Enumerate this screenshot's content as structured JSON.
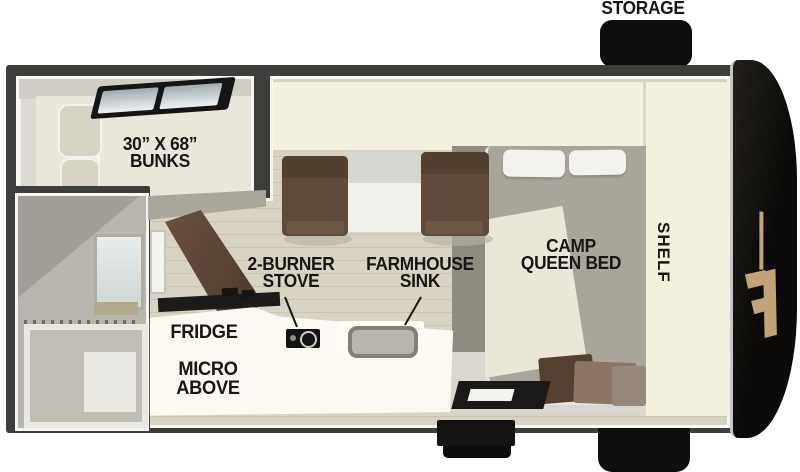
{
  "diagram": {
    "type": "rv-floorplan",
    "labels": {
      "storage": "STORAGE",
      "bunks_line1": "30” X 68”",
      "bunks_line2": "BUNKS",
      "stove_line1": "2-BURNER",
      "stove_line2": "STOVE",
      "sink_line1": "FARMHOUSE",
      "sink_line2": "SINK",
      "bed_line1": "CAMP",
      "bed_line2": "QUEEN BED",
      "shelf": "SHELF",
      "fridge": "FRIDGE",
      "micro_line1": "MICRO",
      "micro_line2": "ABOVE"
    },
    "colors": {
      "background": "#ffffff",
      "wall": "#3e3e3d",
      "wall_trim": "#f7f7f3",
      "floor_plank": "#d8d3c2",
      "floor_plank_line": "#c8c3b2",
      "cream_cabinet": "#f4f0de",
      "carpet_gray": "#8f8b81",
      "mattress_gray": "#a9a59b",
      "blanket_cream": "#ebe7d8",
      "seat_brown": "#604b3a",
      "door_brown": "#5c4536",
      "counter_white": "#fbf9f1",
      "accent_black": "#141312",
      "front_cap_black": "#0b0a08",
      "logo_tan": "#c2a277",
      "label_text": "#171614"
    },
    "icons": {
      "skylight": "skylight-icon (black angled 2-pane window)",
      "stove_burner": "burner-ring-icon (circle outline)",
      "sink_basin": "sink-basin-icon (rounded rect)",
      "shower_curtain": "curtain-rings-icon (dotted strip)",
      "brand_logo": "brand-f-logo-icon (tan polygons)"
    }
  }
}
